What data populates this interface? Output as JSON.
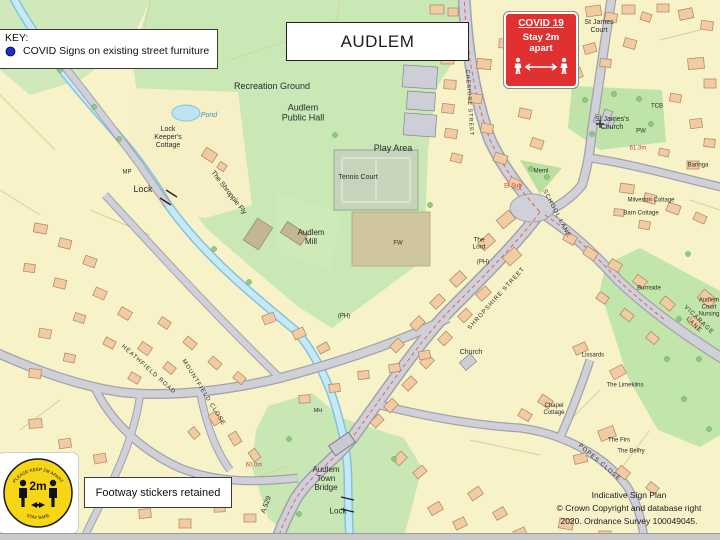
{
  "key": {
    "title": "KEY:",
    "entry": "COVID Signs on existing street furniture",
    "marker_color": "#1a2fd0"
  },
  "title_box": {
    "label": "AUDLEM"
  },
  "covid_sign": {
    "heading": "COVID 19",
    "line1": "Stay 2m",
    "line2": "apart",
    "bg_color": "#e03030"
  },
  "distance_sticker": {
    "top_arc": "PLEASE KEEP 2M APART",
    "value": "2m",
    "bottom_arc": "STAY SAFE",
    "circle_color": "#f7d615"
  },
  "note_box": {
    "label": "Footway stickers retained"
  },
  "attribution": {
    "line1": "Indicative Sign Plan",
    "line2": "© Crown Copyright and database right",
    "line3": "2020. Ordnance Survey 100049045."
  },
  "map": {
    "marker_color": "#1a2fd0",
    "spot_height_color": "#cc4040",
    "water_label_color": "#4090c0",
    "labels": [
      {
        "id": "recreation-ground",
        "t": "Recreation Ground",
        "x": 272,
        "y": 86,
        "s": 9
      },
      {
        "id": "audlem-public-hall",
        "t": "Audlem\nPublic Hall",
        "x": 303,
        "y": 113,
        "s": 9
      },
      {
        "id": "play-area",
        "t": "Play Area",
        "x": 393,
        "y": 148,
        "s": 9
      },
      {
        "id": "tennis-court",
        "t": "Tennis Court",
        "x": 358,
        "y": 178,
        "s": 7
      },
      {
        "id": "audlem-mill",
        "t": "Audlem\nMill",
        "x": 311,
        "y": 237,
        "s": 8
      },
      {
        "id": "pond",
        "t": "Pond",
        "x": 209,
        "y": 116,
        "s": 7,
        "c": "#4090c0",
        "i": 1
      },
      {
        "id": "lock-keepers-cottage",
        "t": "Lock\nKeeper's\nCottage",
        "x": 168,
        "y": 138,
        "s": 7
      },
      {
        "id": "mp",
        "t": "MP",
        "x": 127,
        "y": 173,
        "s": 6
      },
      {
        "id": "lock-upper",
        "t": "Lock",
        "x": 143,
        "y": 189,
        "s": 9
      },
      {
        "id": "the-shroppie-fly",
        "t": "The Shroppie Fly",
        "x": 228,
        "y": 193,
        "s": 7,
        "r": 52
      },
      {
        "id": "st-james-court",
        "t": "St James\nCourt",
        "x": 599,
        "y": 27,
        "s": 7
      },
      {
        "id": "st-jamess-church",
        "t": "St James's\nChurch",
        "x": 612,
        "y": 124,
        "s": 7
      },
      {
        "id": "tcb",
        "t": "TCB",
        "x": 657,
        "y": 107,
        "s": 6
      },
      {
        "id": "baringa",
        "t": "Baringa",
        "x": 698,
        "y": 166,
        "s": 6
      },
      {
        "id": "pw",
        "t": "PW",
        "x": 641,
        "y": 132,
        "s": 6
      },
      {
        "id": "meml",
        "t": "Meml",
        "x": 541,
        "y": 172,
        "s": 6
      },
      {
        "id": "spot-height-613",
        "t": "61.3m",
        "x": 638,
        "y": 149,
        "s": 6,
        "c": "#cc4040"
      },
      {
        "id": "el-sub",
        "t": "El Sub",
        "x": 513,
        "y": 187,
        "s": 6,
        "c": "#cc4040"
      },
      {
        "id": "school-lane",
        "t": "SCHOOL LANE",
        "x": 556,
        "y": 214,
        "s": 6,
        "r": 62,
        "sp": 1
      },
      {
        "id": "cheshire-street",
        "t": "CHESHIRE STREET",
        "x": 469,
        "y": 103,
        "s": 5.5,
        "r": 86,
        "sp": 1
      },
      {
        "id": "the-lord",
        "t": "The\nLord",
        "x": 479,
        "y": 244,
        "s": 6.5
      },
      {
        "id": "ph-lord",
        "t": "(PH)",
        "x": 483,
        "y": 263,
        "s": 6
      },
      {
        "id": "ph-west",
        "t": "(PH)",
        "x": 344,
        "y": 317,
        "s": 6
      },
      {
        "id": "fw",
        "t": "FW",
        "x": 398,
        "y": 244,
        "s": 6
      },
      {
        "id": "church-methodist",
        "t": "Church",
        "x": 471,
        "y": 353,
        "s": 7
      },
      {
        "id": "shropshire-street",
        "t": "SHROPSHIRE STREET",
        "x": 497,
        "y": 299,
        "s": 6,
        "r": -48,
        "sp": 1
      },
      {
        "id": "vicarage-lane",
        "t": "VICARAGE LANE",
        "x": 696,
        "y": 323,
        "s": 6,
        "r": 44,
        "sp": 1
      },
      {
        "id": "burnside",
        "t": "Burnside",
        "x": 649,
        "y": 289,
        "s": 6
      },
      {
        "id": "milverton-cottage",
        "t": "Milverton Cottage",
        "x": 651,
        "y": 201,
        "s": 6
      },
      {
        "id": "barn-cottage",
        "t": "Barn Cottage",
        "x": 641,
        "y": 214,
        "s": 6
      },
      {
        "id": "audlem-court-nursing",
        "t": "Audlem\nCourt\nNursing",
        "x": 709,
        "y": 308,
        "s": 6
      },
      {
        "id": "lissards",
        "t": "Lissards",
        "x": 593,
        "y": 356,
        "s": 6
      },
      {
        "id": "the-limekilns",
        "t": "The Limekilns",
        "x": 625,
        "y": 386,
        "s": 6
      },
      {
        "id": "chapel-cottage",
        "t": "Chapel\nCottage",
        "x": 554,
        "y": 410,
        "s": 6
      },
      {
        "id": "the-firs",
        "t": "The Firs",
        "x": 619,
        "y": 441,
        "s": 6
      },
      {
        "id": "the-belfry",
        "t": "The Belfry",
        "x": 631,
        "y": 452,
        "s": 6
      },
      {
        "id": "popes-close",
        "t": "POPES CLOSE",
        "x": 599,
        "y": 463,
        "s": 6,
        "r": 40,
        "sp": 1
      },
      {
        "id": "audlem-town-bridge",
        "t": "Audlem\nTown\nBridge",
        "x": 326,
        "y": 479,
        "s": 8
      },
      {
        "id": "lock-lower",
        "t": "Lock",
        "x": 338,
        "y": 511,
        "s": 8
      },
      {
        "id": "a529",
        "t": "A 529",
        "x": 267,
        "y": 505,
        "s": 7,
        "r": -70
      },
      {
        "id": "spot-height-600",
        "t": "60.0m",
        "x": 254,
        "y": 466,
        "s": 6,
        "c": "#cc4040"
      },
      {
        "id": "heathfield-road",
        "t": "HEATHFIELD ROAD",
        "x": 148,
        "y": 370,
        "s": 6,
        "r": 42,
        "sp": 1
      },
      {
        "id": "mountfield-close",
        "t": "MOUNTFIELD CLOSE",
        "x": 203,
        "y": 393,
        "s": 6,
        "r": 58,
        "sp": 1
      },
      {
        "id": "mh",
        "t": "MH",
        "x": 318,
        "y": 411,
        "s": 5.5
      }
    ]
  }
}
